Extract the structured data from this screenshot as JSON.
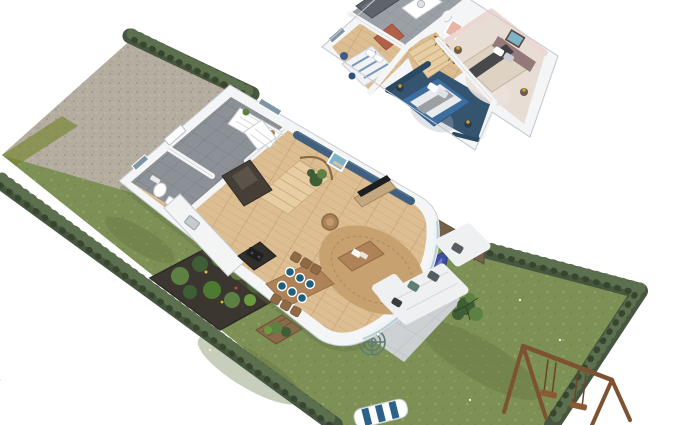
{
  "scene": {
    "type": "isometric 3D floor plan of a two-storey house with garden",
    "floors": [
      {
        "id": "ground-floor",
        "rooms": [
          "entrance-hall",
          "wc",
          "kitchen",
          "dining-area",
          "living-room",
          "staircase"
        ],
        "accent_wall": "steel blue TV wall",
        "dining_seats": 6
      },
      {
        "id": "upper-floor",
        "rooms": [
          "bathroom",
          "bedroom-left",
          "bedroom-pink",
          "bedroom-blue",
          "landing-stairs"
        ],
        "accents": [
          "terracotta wardrobe",
          "pink wall",
          "navy wall"
        ]
      }
    ],
    "garden": {
      "features": [
        "gravel-driveway",
        "lawn",
        "boundary-hedges",
        "paved-terrace",
        "wood-fence",
        "raised-vegetable-bed",
        "crate-planter",
        "swing-set",
        "sun-lounger",
        "string-chairs",
        "outdoor-low-table",
        "surfboard",
        "palm-plant"
      ],
      "string_chairs": 2,
      "swings": 2
    }
  },
  "colors": {
    "bg": "#ffffff",
    "grass": "#7d9055",
    "grass_light": "#9cac70",
    "grass_lime": "#76842f",
    "gravel": "#b5aea0",
    "gravel_dark": "#978f80",
    "hedge": "#47573f",
    "hedge_light": "#5c6f4e",
    "hedge_dark": "#39462f",
    "wall": "#f4f5f6",
    "wall_edge": "#c7ccd1",
    "wall_shade": "#dde0e3",
    "wood": "#ddbe92",
    "wood_line": "#c5a174",
    "tile": "#8b9196",
    "tile_line": "#73797f",
    "bath_tile": "#9aa0a6",
    "shower": "#5d646b",
    "accent_blue": "#41607f",
    "navy_wall": "#2c4964",
    "navy_floor": "#35546f",
    "pink_wall": "#ecd7d2",
    "pink_floor": "#e8ddd5",
    "terracotta": "#b26148",
    "bed_blue": "#3e6e9e",
    "bed_taupe": "#93797a",
    "cream": "#ded3c3",
    "throw_dark": "#3a3d40",
    "sofa": "#eef0f1",
    "cushion_teal": "#5f7d74",
    "cushion_gray": "#575c60",
    "rug": "#c59f6e",
    "rug_pale": "#eae2da",
    "table_wood": "#b08257",
    "chair_wood": "#8f6a45",
    "plate": "#1e5f7e",
    "kitchen_dark": "#453f38",
    "counter": "#f3f4f4",
    "stair": "#e6cda2",
    "paving": "#cdd1d3",
    "paving_line": "#b7bbbe",
    "fence": "#74624a",
    "plant": "#3f5e35",
    "plant_light": "#5d8142",
    "crate": "#8a6a48",
    "swing": "#7c5230",
    "rope": "#6b4527",
    "lounge_stripe": "#2e6189",
    "surf": "#3c4fa3",
    "gold": "#c9a227",
    "black": "#1c1e20",
    "art_sky": "#7fb3c9",
    "art_pink": "#e7b4a8",
    "window_glass": "#7e96a4",
    "basket": "#a9815a"
  }
}
